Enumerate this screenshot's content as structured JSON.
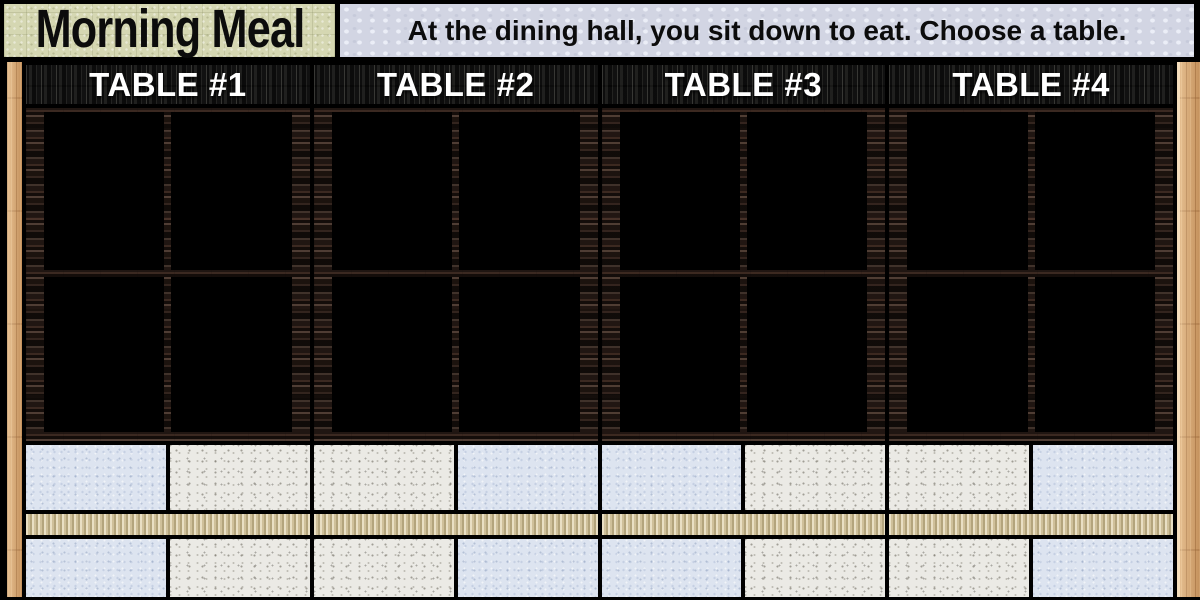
{
  "top_bar": {
    "title": "Morning Meal",
    "instruction": "At the dining hall, you sit down to eat. Choose a table."
  },
  "tables": [
    {
      "label": "TABLE #1"
    },
    {
      "label": "TABLE #2"
    },
    {
      "label": "TABLE #3"
    },
    {
      "label": "TABLE #4"
    }
  ],
  "colors": {
    "title_bg": "#d5d7b2",
    "instruction_bg": "#d2d5e3",
    "wall": "#221813",
    "window": "#000000",
    "pillar": "#d7a670",
    "tile_blue": "#dde4f0",
    "tile_white": "#ebeae5",
    "bench": "#cfc19c",
    "header_wood": "#161616",
    "text_dark": "#0c0c0c",
    "text_light": "#ffffff"
  }
}
